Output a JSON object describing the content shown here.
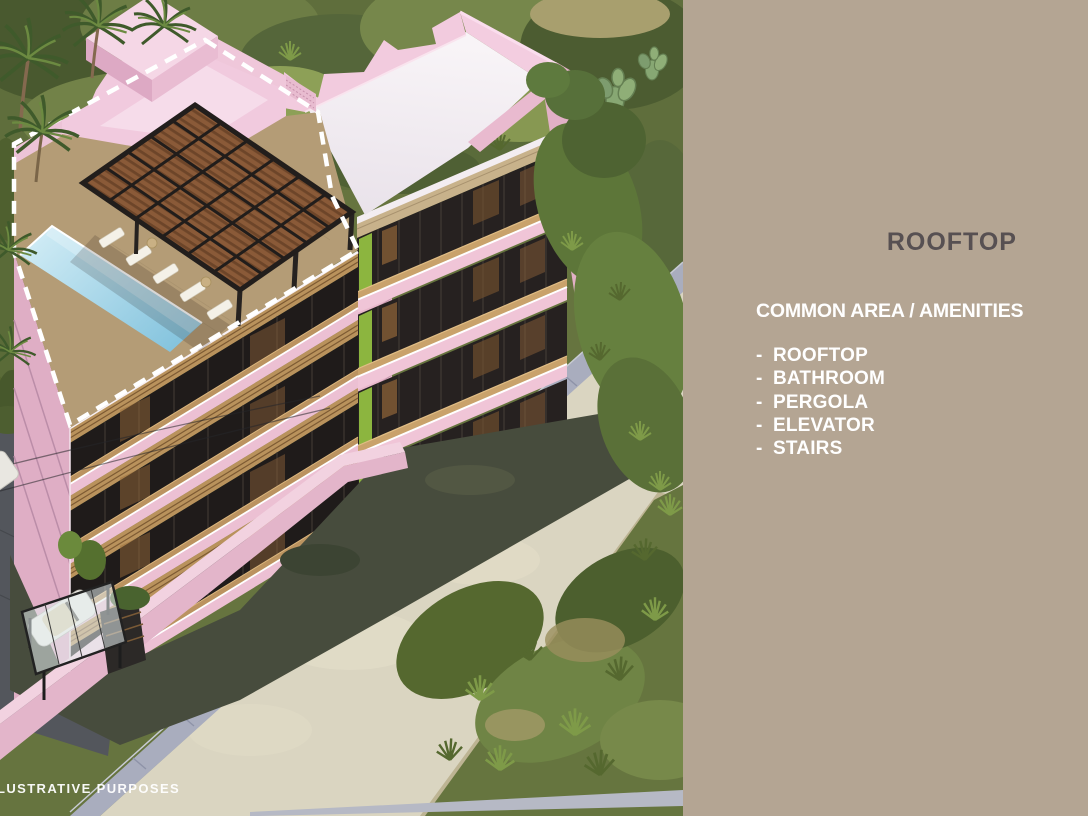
{
  "panel": {
    "title": "ROOFTOP",
    "subtitle": "COMMON AREA / AMENITIES",
    "amenities": [
      {
        "bullet": "-",
        "label": "ROOFTOP"
      },
      {
        "bullet": "-",
        "label": "BATHROOM"
      },
      {
        "bullet": "-",
        "label": "PERGOLA"
      },
      {
        "bullet": "-",
        "label": "ELEVATOR"
      },
      {
        "bullet": "-",
        "label": "STAIRS"
      }
    ],
    "bg_color": "#b4a593",
    "title_color": "#575052",
    "text_color": "#ffffff"
  },
  "watermark": {
    "label": "LUSTRATIVE PURPOSES"
  },
  "illustration": {
    "description_colors": {
      "building_pink": "#efc6d8",
      "building_pink_shaded": "#e2b2c8",
      "roof_white": "#f5f0f3",
      "pool_light": "#cdeaf4",
      "pool_dark": "#85c4de",
      "deck_wood": "#b49c76",
      "pergola_wood": "#8a5a38",
      "pergola_frame": "#221e1c",
      "road": "#dad5c1",
      "curb": "#a9adbe",
      "vegetation": "#5f6e3c",
      "highlight_dash": "#ffffff"
    }
  }
}
